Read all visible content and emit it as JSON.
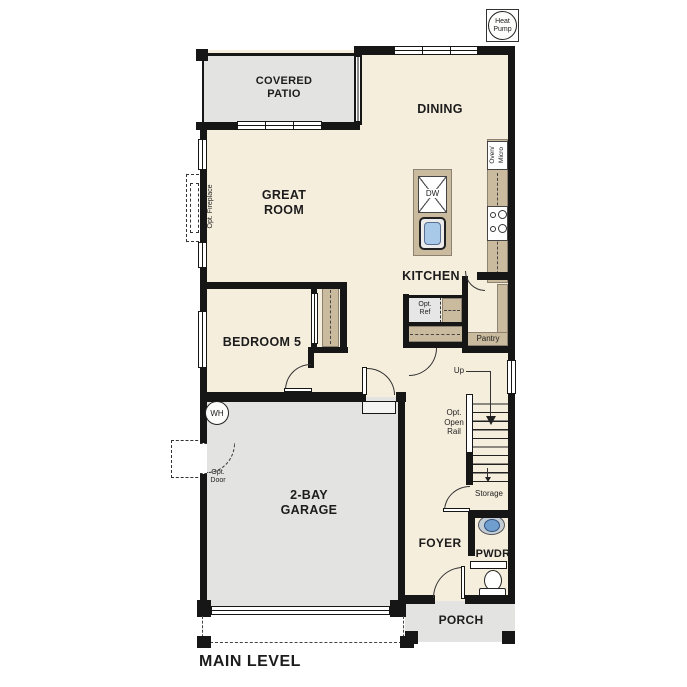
{
  "plan_title": "MAIN LEVEL",
  "rooms": {
    "covered_patio": "COVERED\nPATIO",
    "dining": "DINING",
    "great_room": "GREAT\nROOM",
    "kitchen": "KITCHEN",
    "bedroom5": "BEDROOM 5",
    "garage": "2-BAY\nGARAGE",
    "foyer": "FOYER",
    "pwdr": "PWDR",
    "porch": "PORCH"
  },
  "labels": {
    "pantry": "Pantry",
    "storage": "Storage",
    "up": "Up",
    "opt_open_rail": "Opt.\nOpen\nRail",
    "opt_ref": "Opt.\nRef",
    "opt_door": "Opt.\nDoor",
    "opt_fireplace": "Opt. Fireplace",
    "wh": "WH",
    "dw": "DW",
    "oven_micro": "Oven/\nMicro",
    "heat_pump": "Heat\nPump"
  },
  "colors": {
    "floor": "#f6eedd",
    "concrete": "#e3e3e1",
    "casework": "#cbbb9e",
    "wall": "#161616",
    "sinkblue": "#a9c9e8",
    "pwdrsink": "#6f9ecf"
  }
}
